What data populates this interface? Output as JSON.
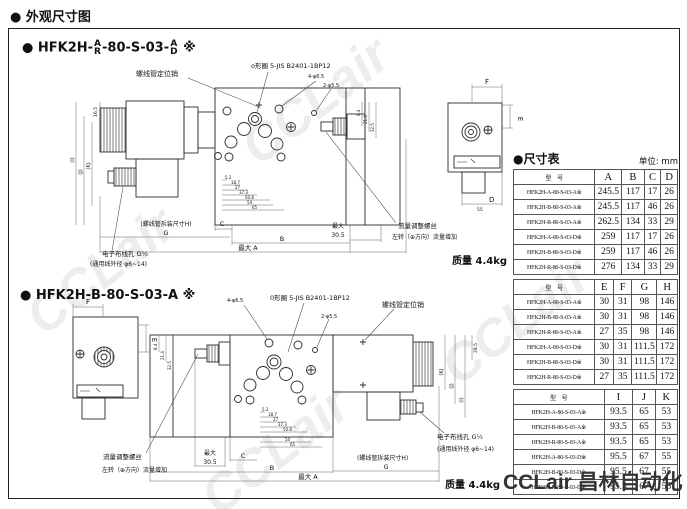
{
  "page": {
    "title": "● 外观尺寸图"
  },
  "sections": {
    "s1": {
      "pre": "● HFK2H-",
      "f1t": "A",
      "f1b": "R",
      "mid": "-80-S-03-",
      "f2t": "A",
      "f2b": "D",
      "suf": "※"
    },
    "s2": {
      "title": "● HFK2H-B-80-S-03-A ※"
    }
  },
  "labels": {
    "pin": "螺线管定位销",
    "oring1": "o形圈 5-JIS B2401-1BP12",
    "oring2": "0形圈 5-JIS B2401-1BP12",
    "holes4": "4-φ6.5",
    "holes2": "2-φ5.5",
    "wiring": "电子布线孔 G½",
    "wire_od": "(通用线外径 φ6~14)",
    "removal_h": "(螺线管拆装尺寸H)",
    "flow_screw": "流量调整螺丝",
    "flow_inc": "左转（⊕方向）流量增加",
    "max": "最大",
    "v305": "30.5",
    "max_a": "最大 A",
    "mass": "质量 4.4kg",
    "B": "B",
    "C": "C",
    "D": "D",
    "E": "E",
    "F": "F",
    "G": "G",
    "d55": "55"
  },
  "dims": {
    "left_chain": [
      "16.5",
      "(I)",
      "(J)",
      "(K)"
    ],
    "right_chain": [
      "28.5",
      "(K)",
      "(J)",
      "(I)"
    ],
    "h_chain": [
      "5.2",
      "18.7",
      "27",
      "37.3",
      "50.8",
      "54",
      "65"
    ],
    "v_chain": [
      "8.4",
      "21.4",
      "32.5"
    ]
  },
  "table": {
    "title": "●尺寸表",
    "unit": "单位: mm",
    "model_header": "型　号",
    "t1": {
      "cols": [
        "A",
        "B",
        "C",
        "D"
      ],
      "rows": [
        [
          "HFK2H-A-80-S-03-A※",
          "245.5",
          "117",
          "17",
          "26"
        ],
        [
          "HFK2H-B-80-S-03-A※",
          "245.5",
          "117",
          "46",
          "26"
        ],
        [
          "HFK2H-R-80-S-03-A※",
          "262.5",
          "134",
          "33",
          "29"
        ],
        [
          "HFK2H-A-80-S-03-D※",
          "259",
          "117",
          "17",
          "26"
        ],
        [
          "HFK2H-B-80-S-03-D※",
          "259",
          "117",
          "46",
          "26"
        ],
        [
          "HFK2H-R-80-S-03-D※",
          "276",
          "134",
          "33",
          "29"
        ]
      ]
    },
    "t2": {
      "cols": [
        "E",
        "F",
        "G",
        "H"
      ],
      "rows": [
        [
          "HFK2H-A-80-S-03-A※",
          "30",
          "31",
          "98",
          "146"
        ],
        [
          "HFK2H-B-80-S-03-A※",
          "30",
          "31",
          "98",
          "146"
        ],
        [
          "HFK2H-R-80-S-03-A※",
          "27",
          "35",
          "98",
          "146"
        ],
        [
          "HFK2H-A-80-S-03-D※",
          "30",
          "31",
          "111.5",
          "172"
        ],
        [
          "HFK2H-B-80-S-03-D※",
          "30",
          "31",
          "111.5",
          "172"
        ],
        [
          "HFK2H-R-80-S-03-D※",
          "27",
          "35",
          "111.5",
          "172"
        ]
      ]
    },
    "t3": {
      "cols": [
        "I",
        "J",
        "K"
      ],
      "rows": [
        [
          "HFK2H-A-80-S-03-A※",
          "93.5",
          "65",
          "53"
        ],
        [
          "HFK2H-B-80-S-03-A※",
          "93.5",
          "65",
          "53"
        ],
        [
          "HFK2H-R-80-S-03-A※",
          "93.5",
          "65",
          "53"
        ],
        [
          "HFK2H-A-80-S-03-D※",
          "95.5",
          "67",
          "55"
        ],
        [
          "HFK2H-B-80-S-03-D※",
          "95.5",
          "67",
          "55"
        ],
        [
          "HFK2H-R-80-S-03-D※",
          "95.5",
          "67",
          "55"
        ]
      ]
    }
  },
  "watermark": {
    "text": "CCLair",
    "brand": "CCLair 昌林自动化"
  }
}
